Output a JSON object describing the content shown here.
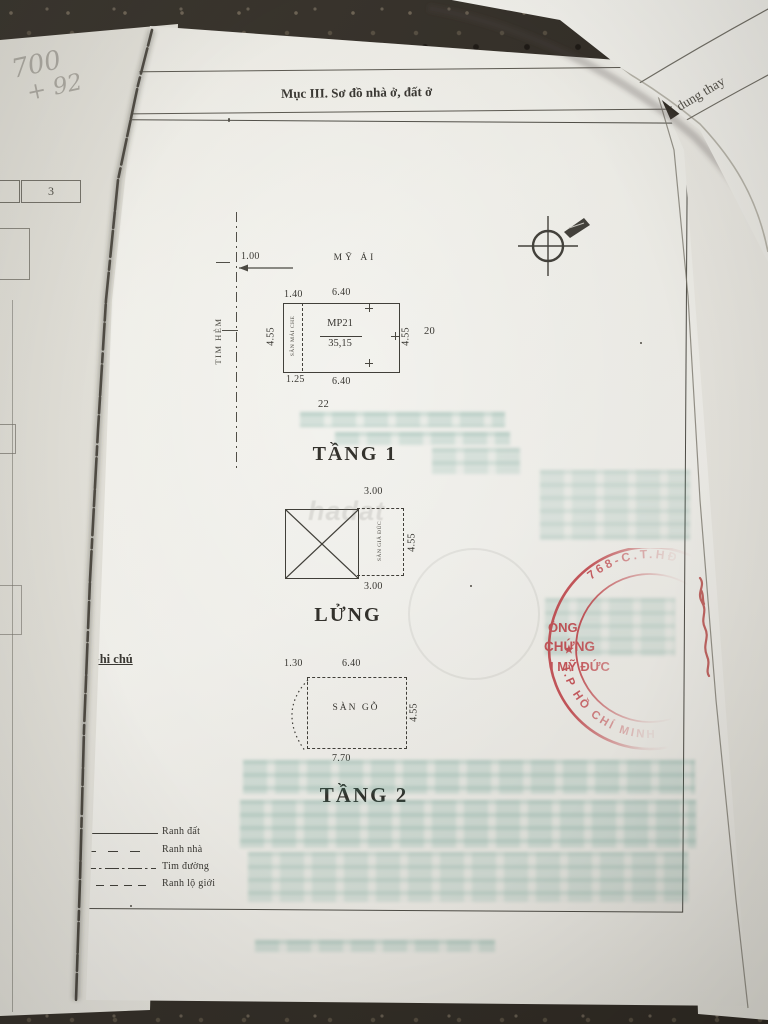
{
  "document": {
    "section_title": "Mục III. Sơ đồ nhà ở, đất ở",
    "floor1": {
      "title": "TẦNG 1",
      "street_name": "MỸ ẢI",
      "alley_axis_label": "TIM HẺM",
      "offset_dim": "1.00",
      "dim_top_left": "1.40",
      "dim_top": "6.40",
      "dim_left": "4.55",
      "dim_right": "4.55",
      "dim_bottom_left": "1.25",
      "dim_bottom": "6.40",
      "parcel_code": "MP21",
      "parcel_area": "35,15",
      "covered_yard_label": "SÂN MÁI CHE",
      "neighbor_right": "20",
      "neighbor_bottom": "22"
    },
    "mezzanine": {
      "title": "LỬNG",
      "dim_top": "3.00",
      "dim_right": "4.55",
      "dim_bottom": "3.00",
      "floor_note": "SÀN GIẢ ĐÚC"
    },
    "floor2": {
      "title": "TẦNG 2",
      "dim_top_left": "1.30",
      "dim_top": "6.40",
      "dim_right": "4.55",
      "dim_bottom": "7.70",
      "floor_note": "SÀN GỖ"
    },
    "legend": {
      "title": "Ghi chú",
      "items": [
        "Ranh đất",
        "Ranh nhà",
        "Tim đường",
        "Ranh lộ giới"
      ]
    },
    "stamp": {
      "arc_top": "768-C.T.HĐ",
      "line1": "ÒNG",
      "line2": "CHỨNG",
      "line3": "Ị MỸ ĐỨC",
      "arc_bottom": "T.P HỒ CHÍ MINH",
      "star": "★",
      "color": "#c03a40"
    },
    "watermark": "hadat"
  },
  "adjacent_page": {
    "header_fragment": "Nội dung thay"
  },
  "under_page": {
    "box_number": "3",
    "pencil_note_line1": "700",
    "pencil_note_line2": "+ 92"
  }
}
